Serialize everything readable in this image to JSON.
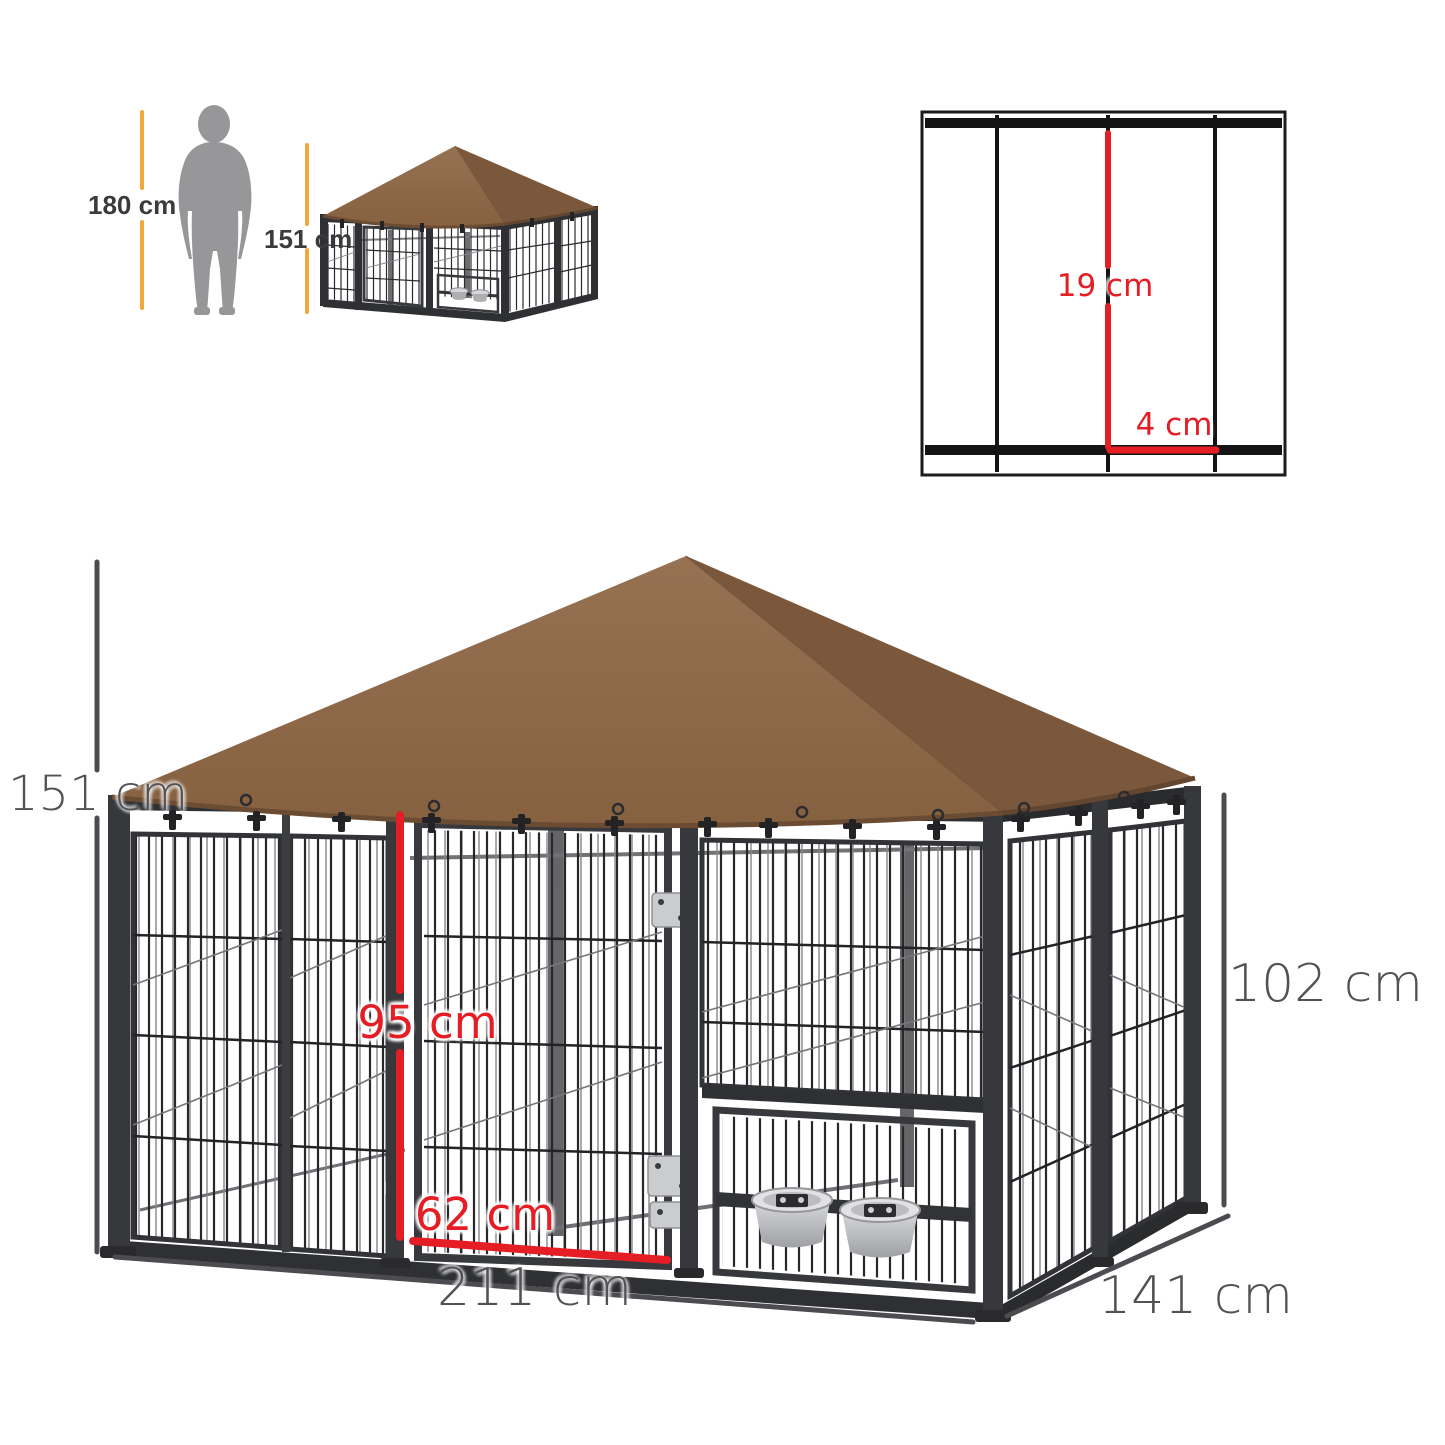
{
  "page": {
    "background_color": "#ffffff",
    "description_labels": {
      "human_height": "180 cm",
      "thumbnail_height": "151 cm",
      "wire_vertical_gap": "19 cm",
      "wire_horizontal_gap": "4 cm",
      "overall_height": "151 cm",
      "door_height": "95 cm",
      "door_width": "62 cm",
      "overall_width": "211 cm",
      "overall_depth": "141 cm",
      "side_wall_height": "102 cm"
    }
  },
  "scale_reference": {
    "human_height_label": "180 cm",
    "thumbnail_height_label": "151 cm"
  },
  "wire_detail": {
    "vertical_gap_label": "19 cm",
    "horizontal_gap_label": "4 cm"
  },
  "dimensions": {
    "overall_height_label": "151 cm",
    "door_height_label": "95 cm",
    "door_width_label": "62 cm",
    "width_label": "211 cm",
    "depth_label": "141 cm",
    "side_height_label": "102 cm"
  },
  "colors": {
    "dimension_red": "#e51e25",
    "dimension_yellow": "#f0a73c",
    "dimension_gray": "#4c4c50",
    "label_gray": "#515156",
    "roof_brown_front": "#8a6246",
    "roof_brown_side": "#7b583b",
    "frame_black": "#2e2f31",
    "bowl_silver": "#c6c7ca",
    "silhouette_gray": "#97979a"
  }
}
